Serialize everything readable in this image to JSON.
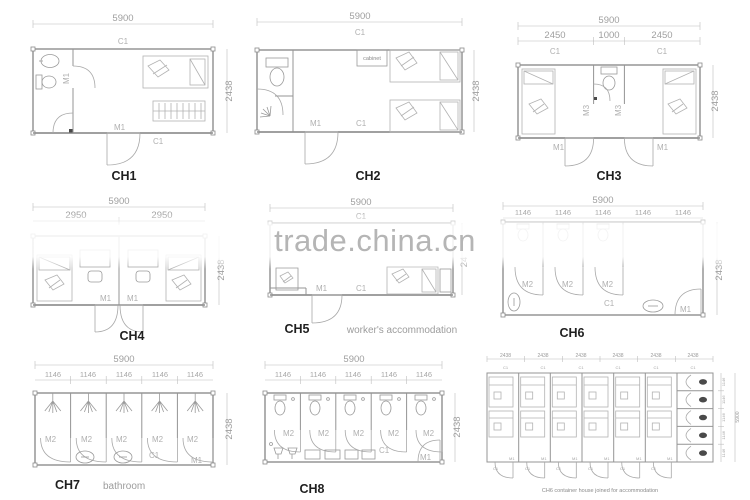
{
  "watermark": {
    "text": "trade.china.cn"
  },
  "plans": {
    "ch1": {
      "title": "CH1",
      "dim_width": "5900",
      "dim_height": "2438",
      "label_top": "C1",
      "label_bottom": "C1",
      "label_door": "M1",
      "label_inner_door": "M1"
    },
    "ch2": {
      "title": "CH2",
      "dim_width": "5900",
      "dim_height": "2438",
      "label_top": "C1",
      "label_bottom": "C1",
      "label_door": "M1",
      "cabinet_label": "cabinet"
    },
    "ch3": {
      "title": "CH3",
      "dim_width": "5900",
      "dim_height": "2438",
      "sub_dims": [
        "2450",
        "1000",
        "2450"
      ],
      "window_labels": [
        "C1",
        "C1"
      ],
      "inner_door_labels": [
        "M3",
        "M3"
      ],
      "door_labels": [
        "M1",
        "M1"
      ]
    },
    "ch4": {
      "title": "CH4",
      "dim_width": "5900",
      "dim_height": "2438",
      "sub_dims": [
        "2950",
        "2950"
      ],
      "door_labels": [
        "M1",
        "M1"
      ]
    },
    "ch5": {
      "title": "CH5",
      "caption": "worker's accommodation",
      "dim_width": "5900",
      "dim_height_partial": "24",
      "label_top": "C1",
      "label_bottom": "C1",
      "label_door": "M1"
    },
    "ch6": {
      "title": "CH6",
      "dim_width": "5900",
      "dim_height": "2438",
      "sub_dims": [
        "1146",
        "1146",
        "1146",
        "1146",
        "1146"
      ],
      "stall_door_labels": [
        "M2",
        "M2",
        "M2"
      ],
      "label_bottom": "C1",
      "label_door": "M1"
    },
    "ch7": {
      "title": "CH7",
      "caption": "bathroom",
      "dim_width": "5900",
      "dim_height": "2438",
      "sub_dims": [
        "1146",
        "1146",
        "1146",
        "1146",
        "1146"
      ],
      "stall_door_labels": [
        "M2",
        "M2",
        "M2",
        "M2",
        "M2"
      ],
      "label_bottom": "C1",
      "label_door": "M1"
    },
    "ch8": {
      "title": "CH8",
      "dim_width": "5900",
      "dim_height": "2438",
      "sub_dims": [
        "1146",
        "1146",
        "1146",
        "1146",
        "1146"
      ],
      "stall_door_labels": [
        "M2",
        "M2",
        "M2",
        "M2",
        "M2"
      ],
      "label_bottom": "C1",
      "label_door": "M1"
    },
    "joined": {
      "caption": "CH6 container house joined for accommodation",
      "top_dims": [
        "2438",
        "2438",
        "2438",
        "2438",
        "2438",
        "2438"
      ],
      "top_window_labels": [
        "C1",
        "C1",
        "C1",
        "C1",
        "C1",
        "C1"
      ],
      "right_dims": [
        "1146",
        "1146",
        "1146",
        "1146",
        "1146"
      ],
      "right_total_dim": "5900",
      "door_label": "M1",
      "window_label": "C1"
    }
  }
}
